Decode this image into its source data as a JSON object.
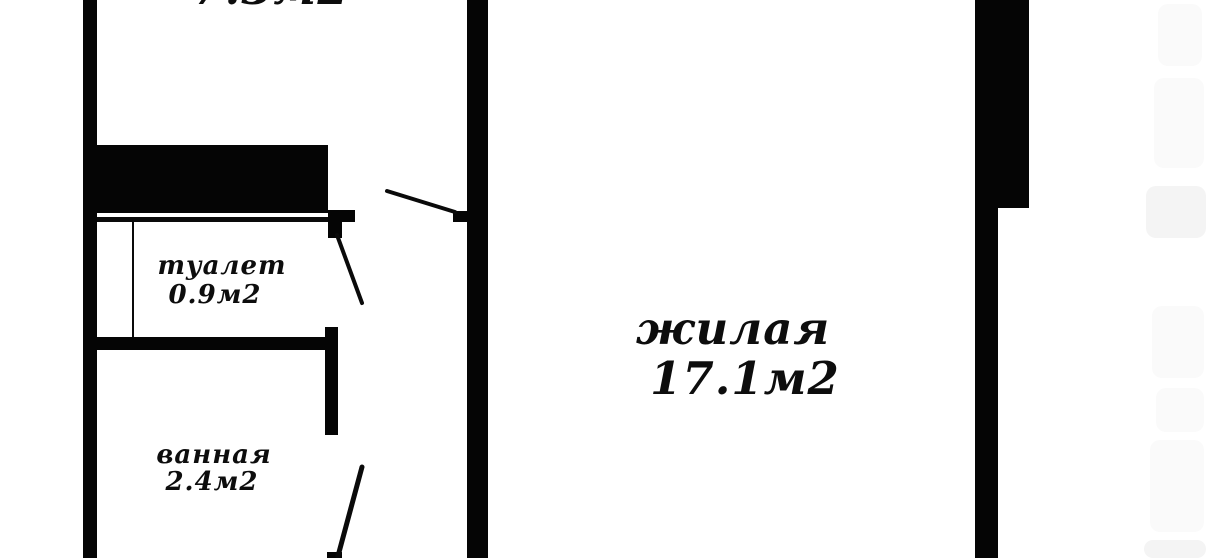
{
  "plan": {
    "type": "apartment-floor-plan",
    "language": "ru",
    "rooms": {
      "top": {
        "area": "7.3м2"
      },
      "toilet": {
        "name": "туалет",
        "area": "0.9м2"
      },
      "bathroom": {
        "name": "ванная",
        "area": "2.4м2"
      },
      "living": {
        "name": "жилая",
        "area": "17.1м2"
      }
    },
    "colors": {
      "wall": "#050505",
      "background": "#ffffff",
      "door_line": "#0a0a0a",
      "watermark": "#fafafa"
    }
  }
}
